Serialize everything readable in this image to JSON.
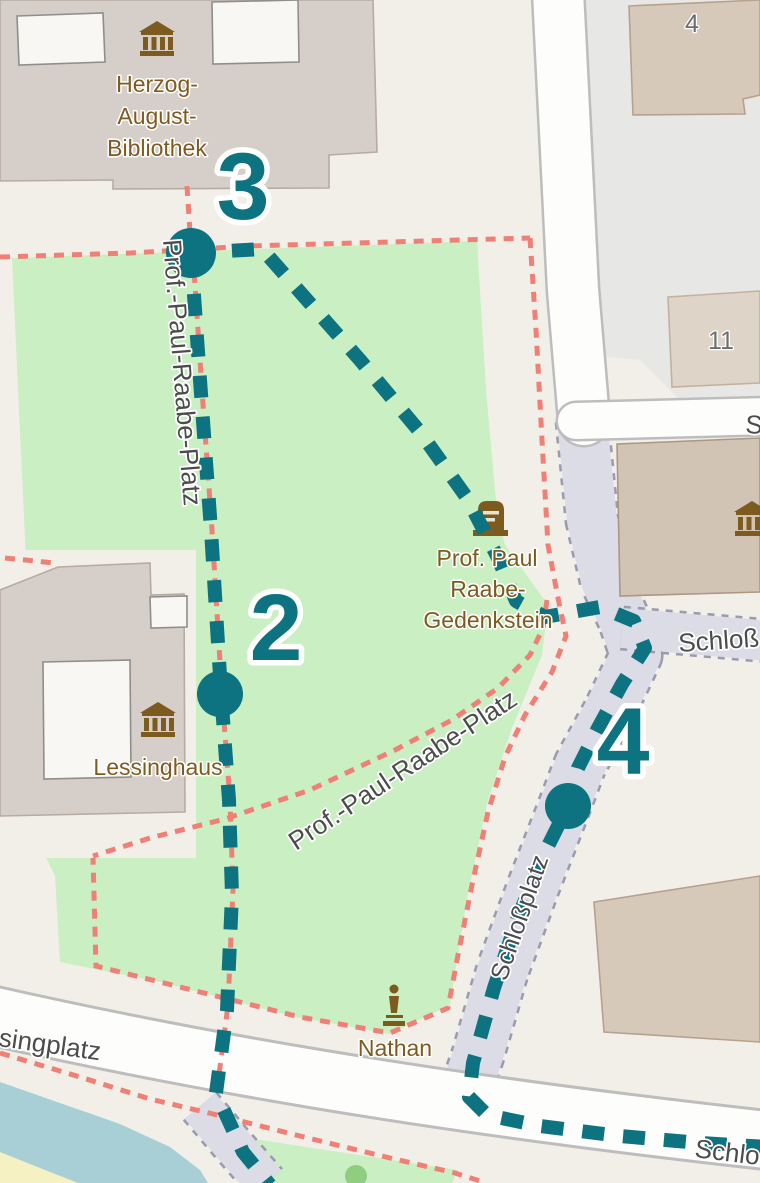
{
  "app": {
    "view": "map-route-overview"
  },
  "colors": {
    "route_teal": "#0e7380",
    "path_red": "#f08076",
    "park_green": "#caefc2",
    "water_blue": "#a9cfd6",
    "land_beige": "#f2efe9",
    "building_gray": "#d6cec8",
    "building_tan": "#d7c9ba",
    "paved_gray": "#e7e7e5",
    "pedestrian_lavender": "#dbdce6",
    "beach_yellow": "#f5f1c3",
    "poi_brown": "#7d5b1f",
    "street_gray": "#4c4c4c",
    "house_number_gray": "#6d6d6d"
  },
  "waypoints": [
    {
      "number": "3",
      "x": 191,
      "y": 253,
      "r": 25,
      "label_x": 243,
      "label_y": 219
    },
    {
      "number": "2",
      "x": 220,
      "y": 694,
      "r": 23,
      "label_x": 276,
      "label_y": 660
    },
    {
      "number": "4",
      "x": 568,
      "y": 806,
      "r": 23,
      "label_x": 623,
      "label_y": 774
    }
  ],
  "labels": [
    {
      "name": "label-herzog-august-bibliothek-line1",
      "type": "poi",
      "text": "Herzog-",
      "x": 157,
      "y": 92
    },
    {
      "name": "label-herzog-august-bibliothek-line2",
      "type": "poi",
      "text": "August-",
      "x": 157,
      "y": 124
    },
    {
      "name": "label-herzog-august-bibliothek-line3",
      "type": "poi",
      "text": "Bibliothek",
      "x": 157,
      "y": 156
    },
    {
      "name": "label-lessinghaus",
      "type": "poi",
      "text": "Lessinghaus",
      "x": 158,
      "y": 775
    },
    {
      "name": "label-gedenkstein-line1",
      "type": "poi",
      "text": "Prof. Paul",
      "x": 487,
      "y": 566
    },
    {
      "name": "label-gedenkstein-line2",
      "type": "poi",
      "text": "Raabe-",
      "x": 488,
      "y": 597
    },
    {
      "name": "label-gedenkstein-line3",
      "type": "poi",
      "text": "Gedenkstein",
      "x": 488,
      "y": 628
    },
    {
      "name": "label-nathan",
      "type": "poi",
      "text": "Nathan",
      "x": 395,
      "y": 1056
    },
    {
      "name": "street-prof-paul-raabe-platz-vertical",
      "type": "street",
      "text": "Prof.-Paul-Raabe-Platz",
      "x": 163,
      "y": 240,
      "rotate": 85.5,
      "anchor": "start"
    },
    {
      "name": "street-prof-paul-raabe-platz-diagonal",
      "type": "street",
      "text": "Prof.-Paul-Raabe-Platz",
      "x": 296,
      "y": 851,
      "rotate": -33.5,
      "anchor": "start"
    },
    {
      "name": "street-lessingplatz-clipped",
      "type": "street",
      "text": "singplatz",
      "x": -2,
      "y": 1046,
      "rotate": 8,
      "anchor": "start"
    },
    {
      "name": "street-schloss-east-clipped",
      "type": "street",
      "text": "Schloß",
      "x": 679,
      "y": 652,
      "rotate": -4,
      "anchor": "start"
    },
    {
      "name": "street-s-clipped",
      "type": "street",
      "text": "S",
      "x": 745,
      "y": 433,
      "rotate": 3,
      "anchor": "start"
    },
    {
      "name": "street-schlossplatz-on-road",
      "type": "street-sm",
      "text": "Schloßplatz",
      "x": 506,
      "y": 982,
      "rotate": -71,
      "anchor": "start"
    },
    {
      "name": "street-schlossplatz-bottom-clipped",
      "type": "street",
      "text": "Schloßpl",
      "x": 694,
      "y": 1157,
      "rotate": 7,
      "anchor": "start"
    },
    {
      "name": "house-number-4",
      "type": "house",
      "text": "4",
      "x": 692,
      "y": 32
    },
    {
      "name": "house-number-11",
      "type": "house",
      "text": "11",
      "x": 721,
      "y": 349
    }
  ]
}
